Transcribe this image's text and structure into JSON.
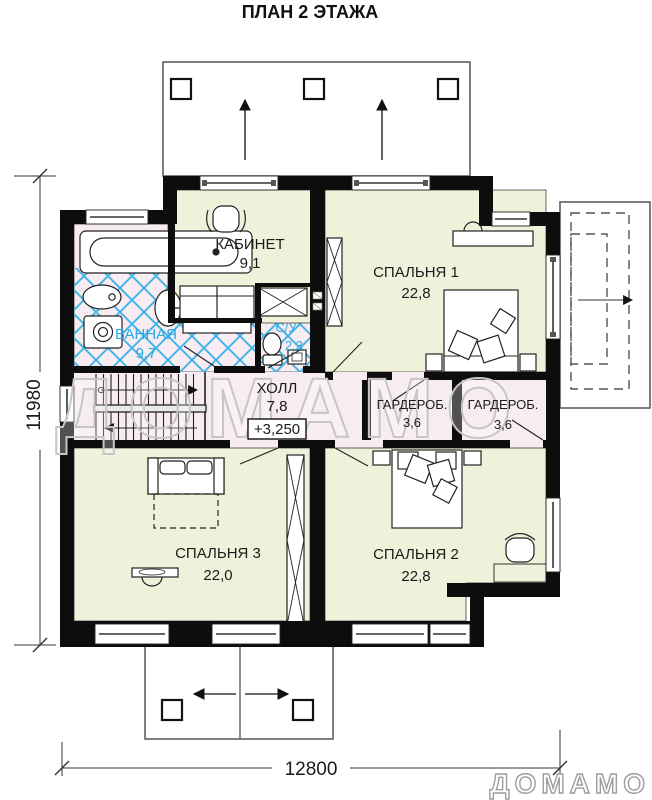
{
  "title": "ПЛАН 2 ЭТАЖА",
  "plan": {
    "rooms": [
      {
        "name": "КАБИНЕТ",
        "area": "9,1"
      },
      {
        "name": "СПАЛЬНЯ 1",
        "area": "22,8"
      },
      {
        "name": "ВАННАЯ",
        "area": "9,7"
      },
      {
        "name": "С/У",
        "area": "2,3"
      },
      {
        "name": "ХОЛЛ",
        "area": "7,8"
      },
      {
        "name": "ГАРДЕРОБ.",
        "area": "3,6"
      },
      {
        "name": "ГАРДЕРОБ.",
        "area": "3,6"
      },
      {
        "name": "СПАЛЬНЯ 3",
        "area": "22,0"
      },
      {
        "name": "СПАЛЬНЯ 2",
        "area": "22,8"
      }
    ],
    "elevation_mark": "+3,250",
    "dimensions": {
      "width_mm": "12800",
      "height_mm": "11980"
    }
  },
  "watermark": "ДОМАМО",
  "logo": "ДОМАМО",
  "colors": {
    "room_yellow": "#eff1da",
    "room_pink": "#f8ecf3",
    "tile_blue": "#45b5e7",
    "label_blue": "#2aa9e0",
    "wall_black": "#0d0d0d"
  }
}
